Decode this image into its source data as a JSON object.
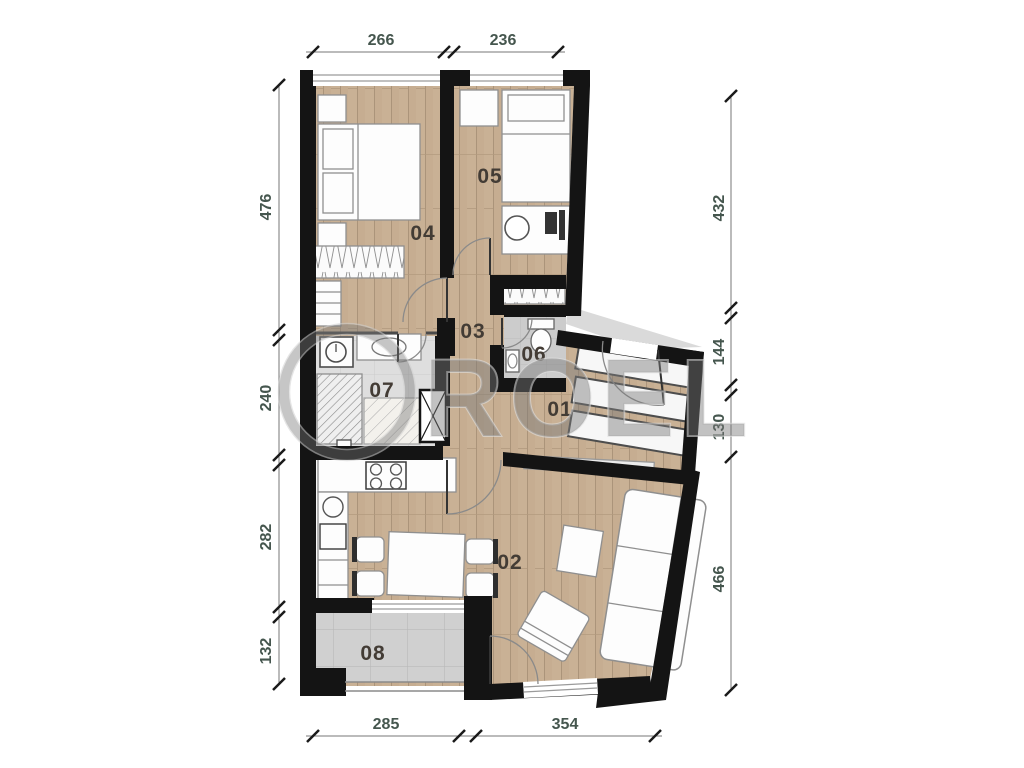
{
  "watermark": {
    "text": "ROEL",
    "color": "#787878"
  },
  "rooms": [
    {
      "id": "01",
      "label": "01",
      "type": "entry-corridor"
    },
    {
      "id": "02",
      "label": "02",
      "type": "living-kitchen"
    },
    {
      "id": "03",
      "label": "03",
      "type": "hall"
    },
    {
      "id": "04",
      "label": "04",
      "type": "bedroom"
    },
    {
      "id": "05",
      "label": "05",
      "type": "bedroom"
    },
    {
      "id": "06",
      "label": "06",
      "type": "wc"
    },
    {
      "id": "07",
      "label": "07",
      "type": "bathroom"
    },
    {
      "id": "08",
      "label": "08",
      "type": "terrace"
    }
  ],
  "dimensions": {
    "top": [
      "266",
      "236"
    ],
    "left": [
      "476",
      "240",
      "282",
      "132"
    ],
    "right": [
      "432",
      "144",
      "130",
      "466"
    ],
    "bottom": [
      "285",
      "354"
    ]
  },
  "colors": {
    "wall": "#141414",
    "woodFloor": "#c9b195",
    "woodLine": "#ab947a",
    "tileFloor": "#cfcfcf",
    "bathFloor": "#dedede",
    "terraceFloor": "#d0d0d0",
    "kitchenFloor": "#f7f7f7",
    "landing": "#dadada",
    "furnitureFill": "#fdfdfd",
    "furnitureStroke": "#8f8f8f",
    "windowGlass": "#9a9a9a",
    "dimLine": "#777777",
    "dimTick": "#1a1a1a",
    "dimText": "#45564e",
    "roomLabel": "#433c35"
  }
}
